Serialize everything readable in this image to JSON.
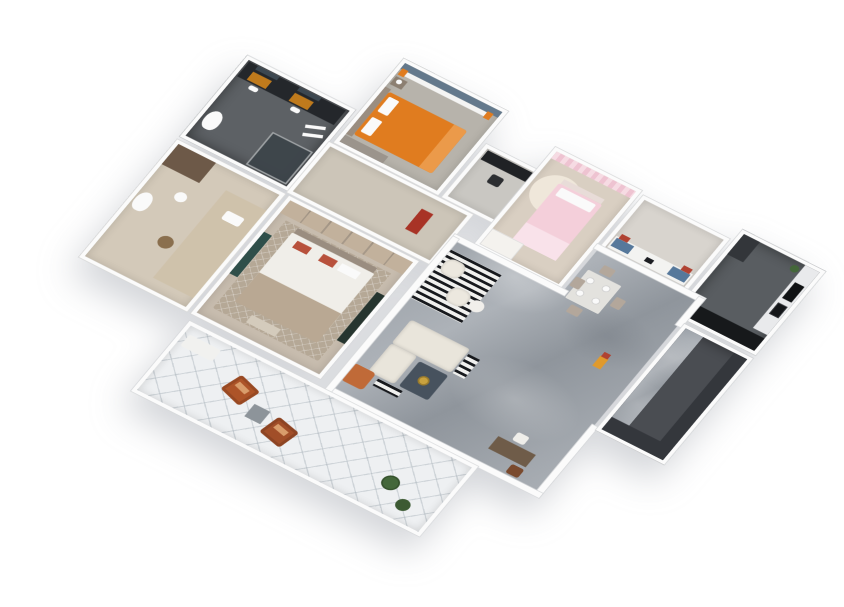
{
  "scene": {
    "description": "3D axonometric rendering of a full apartment floor plan viewed from above, rotated diagonally on a plain white background",
    "view": "isometric top-down, plan rotated ~33 degrees, tilted ~39 degrees",
    "background": "#ffffff"
  },
  "palette": {
    "bg": "#ffffff",
    "wall": "#fbfbfb",
    "wall-edge": "#d7d9db",
    "bath2-floor": "#5d6165",
    "vanity-dark": "#24272b",
    "amber": "#bf7a1c",
    "mirror": "#3c4750",
    "bed2-floor": "#b7b3ab",
    "orange-bed": "#e07c1f",
    "orange-light": "#eb9a4a",
    "accent-blue": "#64798c",
    "gray-wardrobe": "#9b948c",
    "nightstand": "#8c7f71",
    "study-floor": "#c9c7c2",
    "black-furn": "#202225",
    "pink-floor": "#d9cfc2",
    "pink-curtain": "#eec3d1",
    "pink-bed": "#f4cfda",
    "pink-light": "#f9e2ea",
    "cream-rug": "#efe7da",
    "white-furn": "#f4f2ee",
    "nook-floor": "#d8d4ce",
    "bench-blue": "#56789b",
    "red-pillow": "#b04232",
    "kitchen-floor": "#595d61",
    "counter-black": "#17191b",
    "counter-white": "#e9eaec",
    "appliance-black": "#101214",
    "fridge": "#33363a",
    "plant": "#44673a",
    "plant-dark": "#3c5a33",
    "wood-light": "#ccc5b8",
    "red-accent": "#a83326",
    "mbath-floor": "#d3c9b9",
    "brown-cab": "#6d5948",
    "beige-counter": "#cfc2ab",
    "stool": "#8a6f4e",
    "master-floor": "#c7bcae",
    "master-rug": "#b5a896",
    "wardrobe-tan": "#c2b19c",
    "headboard": "#9a8d80",
    "duvet": "#f0eee9",
    "throw": "#b9a893",
    "red-pillow2": "#b8513c",
    "teal": "#2f4f4a",
    "tv-dark": "#26352f",
    "ottoman": "#d4cbbc",
    "sofa": "#e9e5db",
    "coffee": "#47525e",
    "gold": "#c9a23f",
    "orange-chair": "#c06a38",
    "desk-brown": "#6f5c49",
    "chair-brown": "#7a4a2e",
    "chair-taupe": "#b3a79b",
    "table-light": "#e3e2de",
    "balcony-floor": "#eef0f2",
    "rust": "#ad5428",
    "rust2": "#a14e28",
    "rust-cushion": "#d99d6b",
    "cube": "#8d949a",
    "charcoal-wall": "#34373c",
    "charcoal-floor": "#4a4d52",
    "vacuum": "#e09a2d",
    "white": "#fafafa"
  },
  "rooms": [
    {
      "id": "bathroom-2",
      "label": "Bathroom with double vanity",
      "floor": "#5d6165",
      "furniture": [
        "dark double vanity counter",
        "two wall mirrors",
        "amber cabinet doors",
        "two sinks",
        "toilet",
        "glass shower enclosure",
        "white towels"
      ]
    },
    {
      "id": "bedroom-2",
      "label": "Bedroom with orange bed",
      "floor": "#b7b3ab",
      "furniture": [
        "orange double bed",
        "white pillows",
        "gray headboard",
        "nightstand with lamp",
        "white curtains with orange drapes",
        "blue-gray accent wall",
        "low gray wardrobe"
      ]
    },
    {
      "id": "study",
      "label": "Study nook",
      "floor": "#c9c7c2",
      "furniture": [
        "black metal desk",
        "black shelving unit",
        "black desk chair"
      ]
    },
    {
      "id": "bedroom-3",
      "label": "Kids bedroom (pink)",
      "floor": "#d9cfc2",
      "furniture": [
        "pink curtains",
        "round cream rug",
        "pink single bed with white pillow",
        "white wardrobe"
      ]
    },
    {
      "id": "entry-nook",
      "label": "Bench nook",
      "floor": "#d8d4ce",
      "furniture": [
        "long white desk",
        "two blue seat cushions",
        "red throw pillows",
        "black tablet"
      ]
    },
    {
      "id": "kitchen",
      "label": "Kitchen",
      "floor": "#595d61",
      "furniture": [
        "white counter with black cooktop and sink",
        "black base cabinet run",
        "tall dark cabinet",
        "green potted plant"
      ]
    },
    {
      "id": "hallway",
      "label": "Hallway",
      "floor": "#ccc5b8",
      "furniture": [
        "red accent cabinet"
      ]
    },
    {
      "id": "master-bath",
      "label": "Master bath / dressing room",
      "floor": "#d3c9b9",
      "furniture": [
        "brown storage cabinet",
        "toilet",
        "pedestal sink",
        "beige counter platform with sink",
        "round woven stool"
      ]
    },
    {
      "id": "master-bedroom",
      "label": "Master bedroom",
      "floor": "#c7bcae",
      "furniture": [
        "wardrobe run",
        "crosshatch rug",
        "double bed with white duvet and taupe throw",
        "red and white pillows",
        "teal bookshelf",
        "dark TV cabinet",
        "ottoman bench"
      ]
    },
    {
      "id": "living-dining",
      "label": "Living / dining area",
      "floor": "gray marble",
      "furniture": [
        "square dining table with four place settings",
        "four taupe dining chairs",
        "black-and-white striped rug",
        "two cream armchairs",
        "round white side table",
        "cream sofa with chaise",
        "navy coffee table with gold tray",
        "orange accent armchair",
        "black-and-white mats",
        "brown writing desk",
        "white desk chair",
        "brown chair",
        "orange vacuum by entry"
      ]
    },
    {
      "id": "service-area",
      "label": "Service area with dark feature walls",
      "floor": "#4a4d52",
      "furniture": [
        "charcoal feature wall south",
        "charcoal feature wall east"
      ]
    },
    {
      "id": "balcony",
      "label": "Balcony",
      "floor": "#eef0f2",
      "furniture": [
        "white bench",
        "two rust lounge chairs",
        "gray cube side table",
        "two potted plants"
      ]
    }
  ]
}
